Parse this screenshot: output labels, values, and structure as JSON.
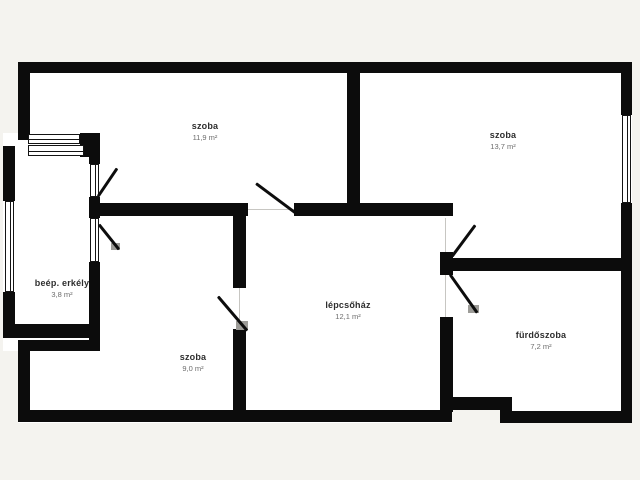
{
  "title": "apartment floor plan",
  "colors": {
    "background": "#f4f3ef",
    "floor": "#ffffff",
    "wall": "#0c0c0c",
    "threshold": "#c7c6c2",
    "jamb": "#9d9c98"
  },
  "rooms": [
    {
      "name": "szoba",
      "area": "11,9 m²",
      "cx": 205,
      "ty": 121
    },
    {
      "name": "szoba",
      "area": "13,7 m²",
      "cx": 503,
      "ty": 130
    },
    {
      "name": "lépcsőház",
      "area": "12,1 m²",
      "cx": 348,
      "ty": 300
    },
    {
      "name": "szoba",
      "area": "9,0 m²",
      "cx": 193,
      "ty": 352
    },
    {
      "name": "fürdőszoba",
      "area": "7,2 m²",
      "cx": 541,
      "ty": 330
    },
    {
      "name": "beép. erkély",
      "area": "3,8 m²",
      "cx": 62,
      "ty": 278
    }
  ],
  "geometry": {
    "floors": [
      [
        18,
        62,
        614,
        361
      ],
      [
        3,
        133,
        97,
        218
      ]
    ],
    "cutouts": [
      [
        452,
        410,
        48,
        13
      ]
    ],
    "walls": [
      [
        18,
        62,
        614,
        11
      ],
      [
        621,
        62,
        11,
        53
      ],
      [
        621,
        203,
        11,
        220
      ],
      [
        18,
        410,
        434,
        12
      ],
      [
        500,
        411,
        132,
        12
      ],
      [
        445,
        397,
        66,
        13
      ],
      [
        500,
        397,
        12,
        26
      ],
      [
        18,
        62,
        12,
        78
      ],
      [
        18,
        340,
        12,
        82
      ],
      [
        18,
        340,
        80,
        11
      ],
      [
        3,
        146,
        12,
        55
      ],
      [
        3,
        292,
        12,
        46
      ],
      [
        8,
        324,
        87,
        14
      ],
      [
        89,
        140,
        11,
        24
      ],
      [
        89,
        197,
        11,
        21
      ],
      [
        89,
        262,
        11,
        89
      ],
      [
        80,
        133,
        20,
        24
      ],
      [
        97,
        203,
        151,
        13
      ],
      [
        294,
        203,
        159,
        13
      ],
      [
        347,
        62,
        13,
        154
      ],
      [
        233,
        216,
        13,
        72
      ],
      [
        233,
        329,
        13,
        81
      ],
      [
        440,
        252,
        13,
        23
      ],
      [
        440,
        317,
        13,
        95
      ],
      [
        440,
        258,
        192,
        13
      ]
    ],
    "windows": [
      {
        "x": 622,
        "y": 115,
        "w": 9,
        "h": 88,
        "o": "v"
      },
      {
        "x": 28,
        "y": 134,
        "w": 52,
        "h": 10,
        "o": "h"
      },
      {
        "x": 28,
        "y": 145,
        "w": 56,
        "h": 11,
        "o": "h"
      },
      {
        "x": 5,
        "y": 201,
        "w": 9,
        "h": 91,
        "o": "v"
      },
      {
        "x": 90,
        "y": 164,
        "w": 9,
        "h": 33,
        "o": "v"
      },
      {
        "x": 90,
        "y": 218,
        "w": 9,
        "h": 44,
        "o": "v"
      }
    ],
    "thresholds": [
      [
        248,
        209,
        46,
        1
      ],
      [
        445,
        218,
        1,
        34
      ],
      [
        445,
        275,
        1,
        42
      ],
      [
        239,
        288,
        1,
        41
      ]
    ],
    "jambs": [
      [
        111,
        243,
        9,
        7
      ],
      [
        236,
        321,
        12,
        9
      ],
      [
        468,
        305,
        11,
        8
      ]
    ],
    "doors": [
      {
        "x1": 98,
        "y1": 196,
        "x2": 117,
        "y2": 168
      },
      {
        "x1": 99,
        "y1": 224,
        "x2": 119,
        "y2": 249
      },
      {
        "x1": 256,
        "y1": 183,
        "x2": 295,
        "y2": 212
      },
      {
        "x1": 452,
        "y1": 256,
        "x2": 475,
        "y2": 225
      },
      {
        "x1": 450,
        "y1": 274,
        "x2": 477,
        "y2": 312
      },
      {
        "x1": 218,
        "y1": 296,
        "x2": 247,
        "y2": 330
      }
    ]
  }
}
